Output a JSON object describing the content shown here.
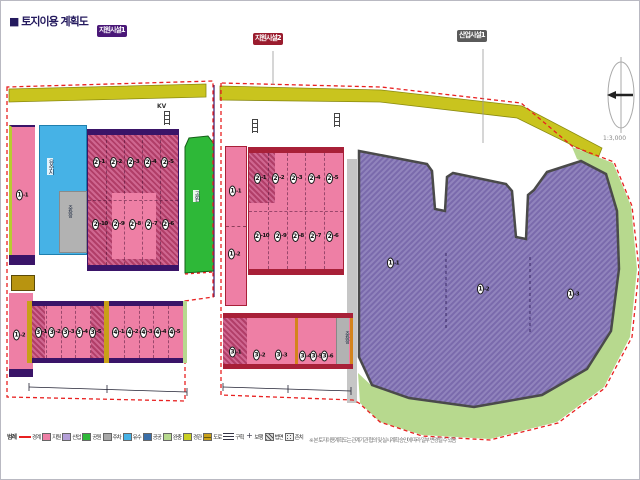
{
  "title": "■ 토지이용 계획도",
  "badges": [
    {
      "label": "지원시설1",
      "color": "#4a1878"
    },
    {
      "label": "지원시설2",
      "color": "#9a1c2e"
    },
    {
      "label": "산업시설1",
      "color": "#5a5a5a"
    }
  ],
  "compass": {
    "scale_text": "1:3,000"
  },
  "parcels": {
    "blue_label": "유수지",
    "gray_label": "주차장",
    "green_label": "공원",
    "mid_gray_label": "주차장",
    "kv_label": "KV"
  },
  "markers": {
    "left_strip": [
      [
        "1",
        "1"
      ],
      [
        "1",
        "2"
      ]
    ],
    "left_main_top": [
      [
        "2",
        "1"
      ],
      [
        "2",
        "2"
      ],
      [
        "2",
        "3"
      ],
      [
        "2",
        "4"
      ],
      [
        "2",
        "5"
      ]
    ],
    "left_main_bottom": [
      [
        "2",
        "10"
      ],
      [
        "2",
        "9"
      ],
      [
        "2",
        "8"
      ],
      [
        "2",
        "7"
      ],
      [
        "2",
        "6"
      ]
    ],
    "left_row_a": [
      [
        "3",
        "1"
      ],
      [
        "3",
        "2"
      ],
      [
        "3",
        "3"
      ],
      [
        "3",
        "4"
      ],
      [
        "3",
        "5"
      ]
    ],
    "left_row_b": [
      [
        "4",
        "1"
      ],
      [
        "4",
        "2"
      ],
      [
        "4",
        "3"
      ],
      [
        "4",
        "4"
      ],
      [
        "4",
        "5"
      ]
    ],
    "mid_strip": [
      [
        "1",
        "1"
      ],
      [
        "1",
        "2"
      ]
    ],
    "mid_main_top": [
      [
        "2",
        "1"
      ],
      [
        "2",
        "2"
      ],
      [
        "2",
        "3"
      ],
      [
        "2",
        "4"
      ],
      [
        "2",
        "5"
      ]
    ],
    "mid_main_bottom": [
      [
        "2",
        "10"
      ],
      [
        "2",
        "9"
      ],
      [
        "2",
        "8"
      ],
      [
        "2",
        "7"
      ],
      [
        "2",
        "6"
      ]
    ],
    "mid_bottom": [
      [
        "3",
        "1"
      ],
      [
        "3",
        "2"
      ],
      [
        "3",
        "3"
      ],
      [
        "3",
        "4"
      ],
      [
        "3",
        "5"
      ],
      [
        "3",
        "6"
      ]
    ],
    "industrial": [
      [
        "1",
        "1"
      ],
      [
        "1",
        "2"
      ],
      [
        "1",
        "3"
      ]
    ]
  },
  "legend": {
    "title": "범례",
    "items": [
      {
        "type": "dash",
        "label": "경계"
      },
      {
        "type": "solid",
        "color": "#ee7fa5",
        "label": "지원"
      },
      {
        "type": "solid",
        "color": "#b49fd8",
        "label": "산업"
      },
      {
        "type": "solid",
        "color": "#2eb838",
        "label": "공원"
      },
      {
        "type": "solid",
        "color": "#a8a8a8",
        "label": "주차"
      },
      {
        "type": "solid",
        "color": "#46b2e6",
        "label": "유수"
      },
      {
        "type": "solid",
        "color": "#3a6ea8",
        "label": "공공"
      },
      {
        "type": "solid",
        "color": "#b7d98e",
        "label": "완충"
      },
      {
        "type": "solid",
        "color": "#c9cf23",
        "label": "경관"
      },
      {
        "type": "road",
        "label": "도로"
      },
      {
        "type": "lines",
        "label": "구획"
      },
      {
        "type": "cross",
        "label": "보행"
      },
      {
        "type": "hatch-dark",
        "label": "법면"
      },
      {
        "type": "hatch-dot",
        "label": "존치"
      }
    ]
  },
  "note": "※ 본 토지이용계획도는 관계기관 협의 및 실시계획 승인에 따라 일부 변경될 수 있음",
  "colors": {
    "boundary": "#e82020",
    "support_pink": "#ee7fa5",
    "industrial_purple": "#9184bd",
    "park_green": "#2eb838",
    "buffer_green": "#b7d98e",
    "road_olive": "#c9c41e"
  }
}
